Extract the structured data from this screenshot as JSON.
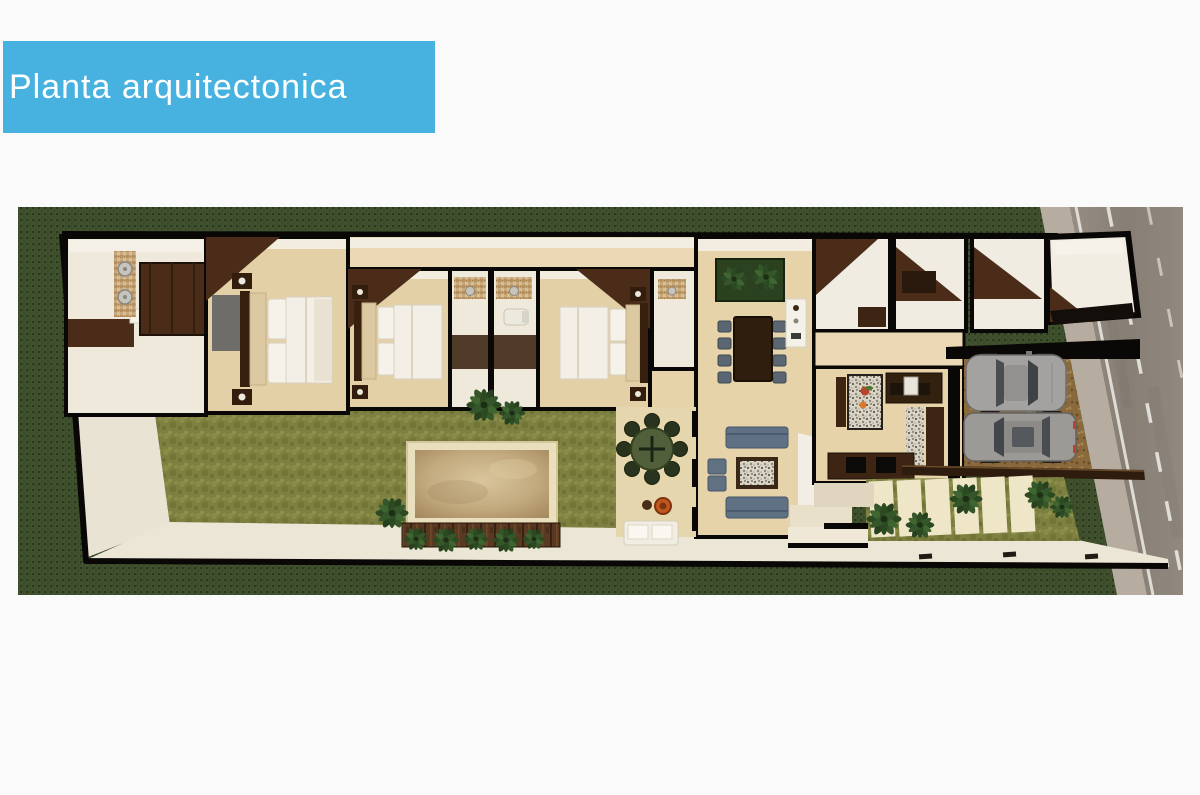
{
  "header": {
    "title": "Planta arquitectonica",
    "background": "#47b2e0",
    "text_color": "#ffffff"
  },
  "plan": {
    "type": "3d-architectural-floor-plan-top-view",
    "areas": [
      "master-bathroom",
      "walk-in-closet",
      "bedroom-1",
      "bedroom-2",
      "bathroom-1",
      "bathroom-2",
      "bedroom-3",
      "bathroom-3",
      "dining-room",
      "living-room",
      "kitchen",
      "utility-rooms",
      "garage-storage",
      "terrace",
      "garden-lawn",
      "pool",
      "wood-deck",
      "entry-walkway",
      "driveway",
      "paver-path",
      "sidewalk",
      "street"
    ],
    "furniture": [
      "double-bed-1",
      "double-bed-2",
      "double-bed-3",
      "dining-table-8-chairs",
      "outdoor-round-table-8-chairs",
      "sofa-top",
      "sofa-bottom",
      "armchairs",
      "coffee-table",
      "kitchen-island",
      "lounge-sofa",
      "fire-bowl",
      "pergola-beam",
      "sedan-car",
      "suv-car",
      "palm-planter",
      "shower-heads",
      "toilet"
    ],
    "colors": {
      "grass_dark": "#3c4c2a",
      "lawn_olive": "#7d8040",
      "floor_beige": "#e3d0a7",
      "wall_white": "#f3efe6",
      "wood_dark": "#3d2413",
      "wall_black": "#0a0806",
      "walkway_cream": "#ece6d6",
      "pool_tan": "#c3a97e",
      "road_gray": "#8d857c",
      "sidewalk_gray": "#b6aca0",
      "sofa_blue": "#5f7183",
      "gravel_brown": "#8a6a3c",
      "outdoor_green": "#51603b",
      "accent_orange": "#c2571e",
      "car_gray": "#a3a2a0"
    }
  }
}
